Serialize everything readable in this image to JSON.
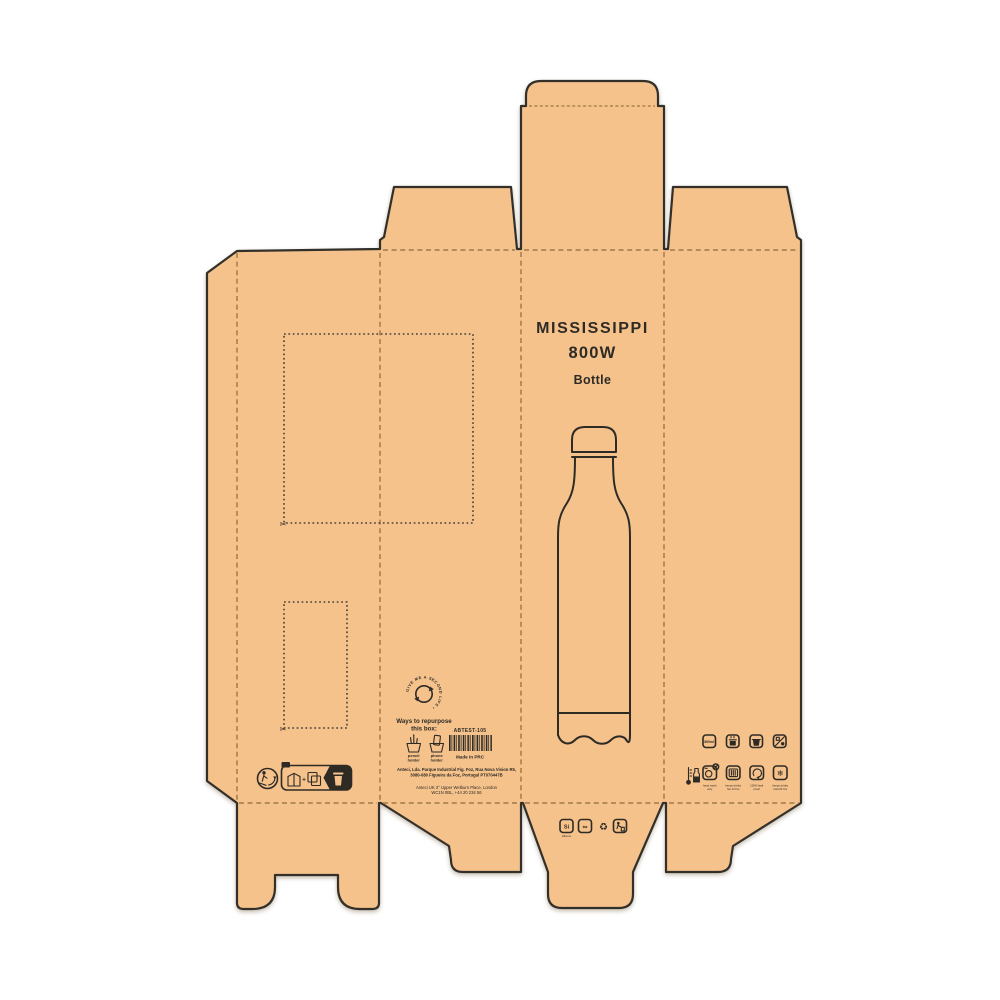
{
  "colors": {
    "kraft": "#f5c28c",
    "ink": "#2e2b25",
    "fold_line": "#9a7444",
    "background": "#ffffff"
  },
  "front_panel": {
    "title_line1": "MISSISSIPPI",
    "title_line2": "800W",
    "subtitle": "Bottle"
  },
  "repurpose": {
    "ring_text": "GIVE ME A SECOND LIFE •",
    "heading_line1": "Ways to repurpose",
    "heading_line2": "this box:",
    "option1_line1": "pencil",
    "option1_line2": "holder",
    "option2_line1": "phone",
    "option2_line2": "holder"
  },
  "barcode": {
    "sku": "ABTEST-105",
    "made_in": "Made in PRC"
  },
  "manufacturer": {
    "line1": "Anteci, Lda. Parque Industrial Fig. Foz, Rua Nova Vision R5,",
    "line2": "3080-080 Figueira da Foz, Portugal PT070447B",
    "line3": "Anteci UK 3° Upper Welburn Place, London",
    "line4": "WC1N 0BL, +44 20 234 56"
  },
  "features": {
    "capacity": "800ml",
    "captions": [
      {
        "line1": "hand wash",
        "line2": "only"
      },
      {
        "line1": "keeps drinks",
        "line2": "hot 12 hrs"
      },
      {
        "line1": "100% leak",
        "line2": "proof"
      },
      {
        "line1": "keeps drinks",
        "line2": "cold 24 hrs"
      }
    ]
  },
  "materials": {
    "silicone_mark": "Si",
    "silicone_caption": "silicone",
    "steel_mark": "∞"
  },
  "glyphs": {
    "scissors": "✂",
    "snowflake": "❄",
    "recycle": "♻",
    "plus": "+"
  }
}
